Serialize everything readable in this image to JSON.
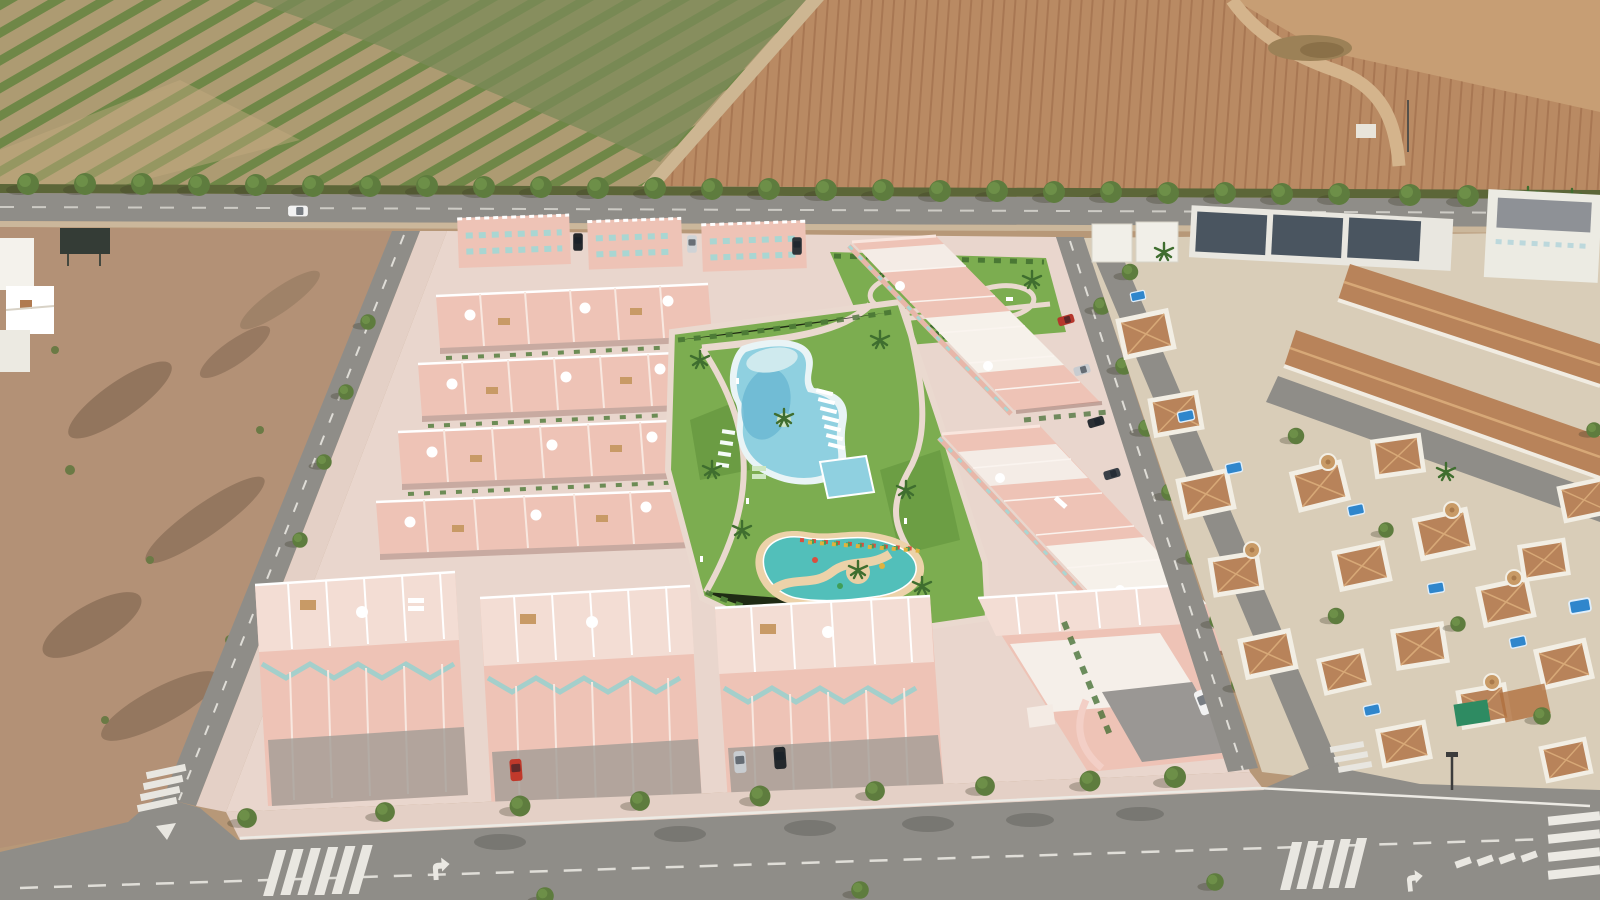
{
  "scene": {
    "type": "aerial-drone-photograph",
    "description": "Aerial view of a new-build residential development of salmon-pink townhouses and apartment blocks arranged around a landscaped park with a lagoon-style pool, a lap pool and a children's splash pool; bordered by a tree-lined avenue, a green orchard field and a ploughed brown field to the north, a vacant dirt plot to the west, and an established neighbourhood of white villas with terracotta roofs and private blue pools to the east; roads with zebra crossings and lane arrows frame the bottom of the image.",
    "no_visible_text": true,
    "time_of_day": "midday, hard sun, shadows falling to the lower-left"
  },
  "palette": {
    "orchard_ground": "#ad9b72",
    "orchard_green": "#6f8747",
    "scrub_green": "#7b8a58",
    "track_tan": "#cdb692",
    "field_brown": "#b98a63",
    "furrow_brown": "#a87753",
    "field_light": "#c79e74",
    "hedge_dark": "#5c6638",
    "asphalt": "#8f8d88",
    "road_marking": "#eae8e2",
    "dirt_lot": "#b39176",
    "dirt_dark": "#6f5a48",
    "hardscape": "#e9d6cd",
    "sidewalk": "#e4d0c6",
    "plaster_salmon": "#eec3b6",
    "plaster_light": "#f3ddd4",
    "trim_white": "#f8e8e0",
    "window_teal": "#a9d6d2",
    "lawn_green": "#7cad50",
    "hedge_green": "#3e6b2e",
    "pool_shallow": "#8fd0e0",
    "pool_deep": "#6cb9d2",
    "pool_rim": "#e9f4f6",
    "kids_pool_teal": "#52bfba",
    "sand_path": "#ecd2a9",
    "villa_wall": "#f2eee4",
    "villa_roof": "#b8835a",
    "villa_roof_ridge": "#d7a877",
    "villa_pool_blue": "#2f86cc",
    "modern_roof_gray": "#4a5560",
    "tree_green": "#5e7c3e",
    "tree_light": "#6f9149",
    "car_red": "#c0392b",
    "car_white": "#f2f2f2",
    "car_silver": "#c8ccd0",
    "car_dark": "#24282c",
    "pergola_green": "#2e8b62"
  },
  "landmarks": {
    "north_west": "orchard with diagonal crop rows",
    "north_east": "ploughed field with furrows and dirt track",
    "main_road": "east-west avenue lined with evenly spaced trees",
    "west": "vacant scrub plot and small white buildings",
    "center": "pink development: townhouse rows, top apartment blocks, central park",
    "pools": [
      "freeform lagoon pool",
      "rectangular lap pool",
      "children's splash pool with sand path"
    ],
    "east": "white villas with terracotta roofs, turrets and private pools",
    "south": "boulevard with sidewalk trees, zebra crossings, yield markings and turn arrows"
  },
  "vehicles": {
    "on_main_road": "white car",
    "top_driveways": [
      "dark",
      "silver",
      "dark"
    ],
    "front_driveways": [
      "red",
      "silver",
      "dark grey"
    ],
    "corner_suv": "white",
    "east_street_parked": [
      "red",
      "silver",
      "dark"
    ]
  }
}
